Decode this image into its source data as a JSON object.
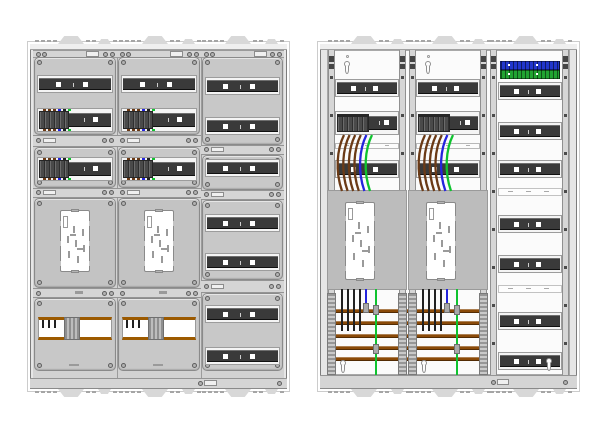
{
  "colors": {
    "bg": "#ffffff",
    "frame": "#e6e6e6",
    "frame-band": "#efefef",
    "panel": "#c8c8c8",
    "strip": "#d5d5d5",
    "band": "#f4f4f4",
    "rail-dark": "#3a3a3a",
    "device-dark": "#4c4c4c",
    "meter-bg-left": "#c3c3c3",
    "meter-bg-right": "#bcbcbc",
    "plate": "#ffffff",
    "plate-mark": "#9a9a9a",
    "busbar": "#8a4a08",
    "window-brown": "#9c5a00",
    "wire-brown": "#6b3a16",
    "wire-blue": "#2424dd",
    "wire-green": "#0fc32f",
    "wire-black": "#212121",
    "terminal-blue": "#2136cc",
    "terminal-green": "#21a432",
    "vrail": "#d6d6d6",
    "vrail-clip": "#454545",
    "screw": "#b2b2b2",
    "connector": "#a9a9a9",
    "knockout": "#d8d8d8",
    "outline": "#8a8a8a"
  },
  "left_cabinet": {
    "label": "meter-cabinet-front-covers",
    "columns": [
      "meter-column-1",
      "meter-column-2",
      "reserve-rail-column"
    ],
    "device_dot_colors": [
      "#6b3a16",
      "#6b3a16",
      "#6b3a16",
      "#2424dd",
      "#212121",
      "#0fc32f"
    ],
    "meter_plates": 2,
    "busbar_windows": 2,
    "reserve_rail_rows": 7
  },
  "right_cabinet": {
    "label": "meter-cabinet-internal-wiring",
    "fields": [
      "meter-field-1",
      "meter-field-2",
      "distribution-field"
    ],
    "terminal_blocks": [
      "neutral-blue",
      "earth-green"
    ],
    "tail_wire_colors": [
      "#6b3a16",
      "#6b3a16",
      "#6b3a16",
      "#6b3a16",
      "#2424dd",
      "#0fc32f"
    ],
    "drop_wires": {
      "black_phase_count": 4,
      "neutral_color": "#2424dd",
      "earth_color": "#0fc32f"
    },
    "busbar_count": 5,
    "distribution_rail_rows": 7,
    "meter_plates": 2
  }
}
